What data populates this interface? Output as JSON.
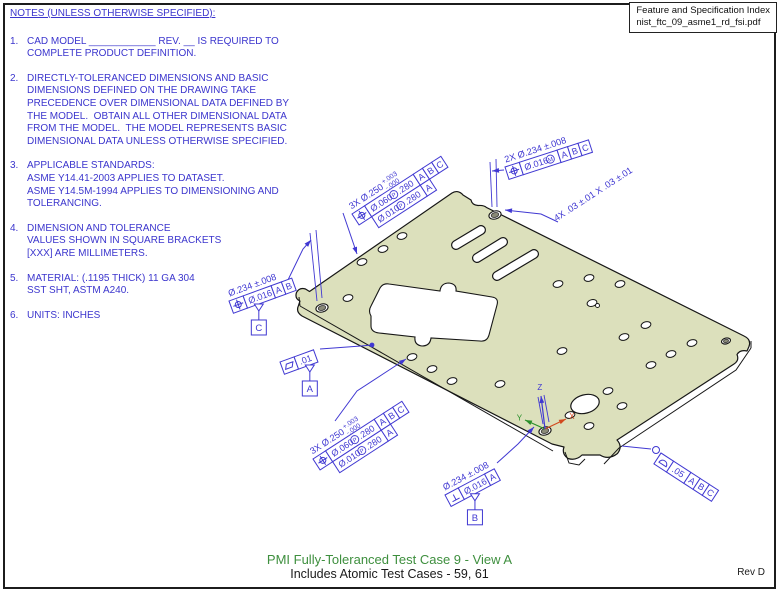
{
  "notes": {
    "heading": "NOTES (UNLESS OTHERWISE SPECIFIED):",
    "items": [
      {
        "num": "1.",
        "lines": [
          "CAD MODEL ____________ REV. __ IS REQUIRED TO",
          "COMPLETE PRODUCT DEFINITION."
        ]
      },
      {
        "num": "2.",
        "lines": [
          "DIRECTLY-TOLERANCED DIMENSIONS AND BASIC",
          "DIMENSIONS DEFINED ON THE DRAWING TAKE",
          "PRECEDENCE OVER DIMENSIONAL DATA DEFINED BY",
          "THE MODEL.  OBTAIN ALL OTHER DIMENSIONAL DATA",
          "FROM THE MODEL.  THE MODEL REPRESENTS BASIC",
          "DIMENSIONAL DATA UNLESS OTHERWISE SPECIFIED."
        ]
      },
      {
        "num": "3.",
        "lines": [
          "APPLICABLE STANDARDS:",
          "ASME Y14.41-2003 APPLIES TO DATASET.",
          "ASME Y14.5M-1994 APPLIES TO DIMENSIONING AND",
          "TOLERANCING."
        ]
      },
      {
        "num": "4.",
        "lines": [
          "DIMENSION AND TOLERANCE",
          "VALUES SHOWN IN SQUARE BRACKETS",
          "[XXX] ARE MILLIMETERS."
        ]
      },
      {
        "num": "5.",
        "lines": [
          "MATERIAL: (.1195 THICK) 11 GA 304",
          "SST SHT, ASTM A240."
        ]
      },
      {
        "num": "6.",
        "lines": [
          "UNITS: INCHES"
        ]
      }
    ]
  },
  "index_box": {
    "line1": "Feature and Specification Index",
    "line2": "nist_ftc_09_asme1_rd_fsi.pdf"
  },
  "footer": {
    "title": "PMI Fully-Toleranced Test Case 9 - View A",
    "subtitle": "Includes Atomic Test Cases - 59, 61",
    "rev": "Rev D"
  },
  "drawing": {
    "colors": {
      "blue": "#4038d2",
      "black": "#161616",
      "plate_fill": "#dce0bc",
      "ring_fill": "#8a8a78",
      "triad_x": "#d2491e",
      "triad_y": "#2a8f2a",
      "triad_z": "#4038d2"
    },
    "plate_outline": "M 452,193 C 456,190.5 460,191.5 463,195 L 471,200 Q 472,205 478,205.5 Q 484,205 486.5,207.5 L 744,336 Q 751.5,339.5 749,346.5 L 747,351 Q 740,349.5 737,354.5 Q 739.5,360.5 734,364 L 617,440 Q 623,446.5 617.5,453.5 Q 608.5,460.5 600,455 L 582,455 Q 576,461 568,458.5 Q 561.5,454 564,447 L 552,444 L 302,316 Q 295.5,312 298.5,305.5 L 300,301 Q 294.5,298.5 296.5,292.5 Q 299.5,287 305.5,289 L 309.5,291.5 Z",
    "thickness": [
      "M300,306 L553,451",
      "M565,452 L569,463 L579,465 L585,459",
      "M604,464 L619,448 L736,370 L751,348",
      "M299,297 L300,306",
      "M751,341 L751,348"
    ],
    "cutout": "M 371,316 Q 368,311 371,306 L 380,288 Q 383,283 389,284 L 440,291 Q 441,283 449,283 Q 457,284 456,291 L 492,297 Q 499,298 497,305 L 489,335 Q 487,342 480,341 L 431,338 Q 430,346 422,346 Q 414,345 415,337 L 379,333 Q 371,332 371,326 Z",
    "slots": [
      [
        456,
        245,
        481,
        230
      ],
      [
        477,
        258,
        503,
        242
      ],
      [
        497,
        276,
        534,
        254
      ]
    ],
    "holes_small": [
      [
        402,
        236
      ],
      [
        383,
        249
      ],
      [
        362,
        262
      ],
      [
        348,
        298
      ],
      [
        412,
        357
      ],
      [
        432,
        369
      ],
      [
        452,
        381
      ],
      [
        500,
        384
      ],
      [
        562,
        351
      ],
      [
        558,
        284
      ],
      [
        589,
        278
      ],
      [
        620,
        284
      ],
      [
        646,
        325
      ],
      [
        624,
        337
      ],
      [
        671,
        354
      ],
      [
        692,
        343
      ],
      [
        651,
        365
      ],
      [
        608,
        391
      ],
      [
        622,
        406
      ],
      [
        589,
        426
      ],
      [
        570,
        415
      ]
    ],
    "keyhole": {
      "x": 592,
      "y": 303
    },
    "holes_ring": [
      {
        "x": 495,
        "y": 215,
        "rx": 6.2,
        "ry": 4.0,
        "irx": 3.8,
        "iry": 2.4
      },
      {
        "x": 322,
        "y": 308,
        "rx": 6.2,
        "ry": 4.0,
        "irx": 3.8,
        "iry": 2.4
      },
      {
        "x": 545,
        "y": 431,
        "rx": 6.2,
        "ry": 4.0,
        "irx": 3.8,
        "iry": 2.4
      },
      {
        "x": 726,
        "y": 341,
        "rx": 4.6,
        "ry": 2.9,
        "irx": 2.6,
        "iry": 1.6
      }
    ],
    "hole_large": {
      "x": 585,
      "y": 404,
      "rx": 14.5,
      "ry": 9.2
    },
    "ext_lines": [
      [
        490,
        162,
        492,
        207
      ],
      [
        496,
        159,
        497,
        207
      ],
      [
        310,
        233,
        317,
        301
      ],
      [
        316,
        230,
        322,
        298
      ],
      [
        538,
        397,
        543,
        424
      ],
      [
        544,
        395,
        549,
        422
      ]
    ],
    "leaders": [
      {
        "name": "leader-top-3x-holes",
        "pts": [
          [
            343,
            213
          ],
          [
            357,
            254
          ]
        ],
        "end": "arrow"
      },
      {
        "name": "leader-2x-holes",
        "pts": [
          [
            504,
            170
          ],
          [
            492,
            171
          ]
        ],
        "end": "arrow"
      },
      {
        "name": "leader-4x-chamfer",
        "pts": [
          [
            558,
            222
          ],
          [
            541,
            214
          ],
          [
            505,
            210
          ]
        ],
        "end": "arrow"
      },
      {
        "name": "leader-datum-c-hole",
        "pts": [
          [
            287,
            282
          ],
          [
            303,
            249
          ],
          [
            311,
            240
          ]
        ],
        "end": "arrow"
      },
      {
        "name": "leader-flatness",
        "pts": [
          [
            320,
            349
          ],
          [
            361,
            346
          ],
          [
            372,
            345
          ]
        ],
        "end": "dot"
      },
      {
        "name": "leader-bottom-3x-holes",
        "pts": [
          [
            335,
            421
          ],
          [
            357,
            391
          ],
          [
            406,
            359
          ]
        ],
        "end": "arrow"
      },
      {
        "name": "leader-datum-b-hole",
        "pts": [
          [
            497,
            463
          ],
          [
            518,
            444
          ],
          [
            534,
            427
          ]
        ],
        "end": "arrow"
      },
      {
        "name": "leader-profile",
        "pts": [
          [
            622,
            446
          ],
          [
            651,
            449
          ]
        ],
        "end": "circle"
      }
    ],
    "callouts": [
      {
        "name": "callout-top-3x-holes",
        "x": 352,
        "y": 214,
        "rot": -33,
        "dim": {
          "text": "3X Ø.250",
          "plus": "+.003",
          "minus": "-.000"
        },
        "rows": [
          {
            "indent": 0,
            "cells": [
              {
                "sym": "pos"
              },
              {
                "t": "Ø.060",
                "mod": "P",
                "t2": ".280"
              },
              {
                "t": "A"
              },
              {
                "t": "B"
              },
              {
                "t": "C"
              }
            ]
          },
          {
            "indent": 15,
            "cells": [
              {
                "t": "Ø.010",
                "mod": "P",
                "t2": ".280"
              },
              {
                "t": "A"
              }
            ]
          }
        ]
      },
      {
        "name": "callout-2x-holes",
        "x": 505,
        "y": 167,
        "rot": -18,
        "dim": {
          "text": "2X Ø.234 ±.008"
        },
        "rows": [
          {
            "indent": 0,
            "cells": [
              {
                "sym": "pos"
              },
              {
                "t": "Ø.016",
                "mod": "M"
              },
              {
                "t": "A"
              },
              {
                "t": "B"
              },
              {
                "t": "C"
              }
            ]
          }
        ]
      },
      {
        "name": "callout-4x-chamfer",
        "x": 557,
        "y": 226,
        "rot": -33,
        "dim": {
          "text": "4X .03 ±.01 X .03 ±.01"
        },
        "rows": []
      },
      {
        "name": "callout-datum-c-hole",
        "x": 229,
        "y": 301,
        "rot": -20,
        "dim": {
          "text": "Ø.234 ±.008"
        },
        "rows": [
          {
            "indent": 0,
            "cells": [
              {
                "sym": "pos"
              },
              {
                "t": "Ø.016"
              },
              {
                "t": "A"
              },
              {
                "t": "B"
              }
            ]
          }
        ],
        "datum": "C"
      },
      {
        "name": "callout-flatness",
        "x": 280,
        "y": 362,
        "rot": -20,
        "rows": [
          {
            "indent": 0,
            "cells": [
              {
                "sym": "flat"
              },
              {
                "t": ".01"
              }
            ]
          }
        ],
        "datum": "A"
      },
      {
        "name": "callout-bottom-3x-holes",
        "x": 313,
        "y": 459,
        "rot": -33,
        "dim": {
          "text": "3X Ø.250",
          "plus": "+.003",
          "minus": "-.000"
        },
        "rows": [
          {
            "indent": 0,
            "cells": [
              {
                "sym": "pos"
              },
              {
                "t": "Ø.060",
                "mod": "P",
                "t2": ".280"
              },
              {
                "t": "A"
              },
              {
                "t": "B"
              },
              {
                "t": "C"
              }
            ]
          },
          {
            "indent": 15,
            "cells": [
              {
                "t": "Ø.010",
                "mod": "P",
                "t2": ".280"
              },
              {
                "t": "A"
              }
            ]
          }
        ]
      },
      {
        "name": "callout-datum-b-hole",
        "x": 445,
        "y": 495,
        "rot": -28,
        "dim": {
          "text": "Ø.234 ±.008"
        },
        "rows": [
          {
            "indent": 0,
            "cells": [
              {
                "sym": "perp"
              },
              {
                "t": "Ø.016"
              },
              {
                "t": "A"
              }
            ]
          }
        ],
        "datum": "B"
      },
      {
        "name": "callout-profile",
        "x": 661,
        "y": 453,
        "rot": 33,
        "rows": [
          {
            "indent": 0,
            "cells": [
              {
                "sym": "prof"
              },
              {
                "t": ".05"
              },
              {
                "t": "A"
              },
              {
                "t": "B"
              },
              {
                "t": "C"
              }
            ]
          }
        ]
      }
    ],
    "triad": {
      "origin": [
        545,
        429
      ],
      "x": {
        "to": [
          566,
          419
        ],
        "label": "X"
      },
      "y": {
        "to": [
          525,
          420
        ],
        "label": "Y"
      },
      "z": {
        "to": [
          541,
          396
        ],
        "label": "Z"
      }
    }
  }
}
